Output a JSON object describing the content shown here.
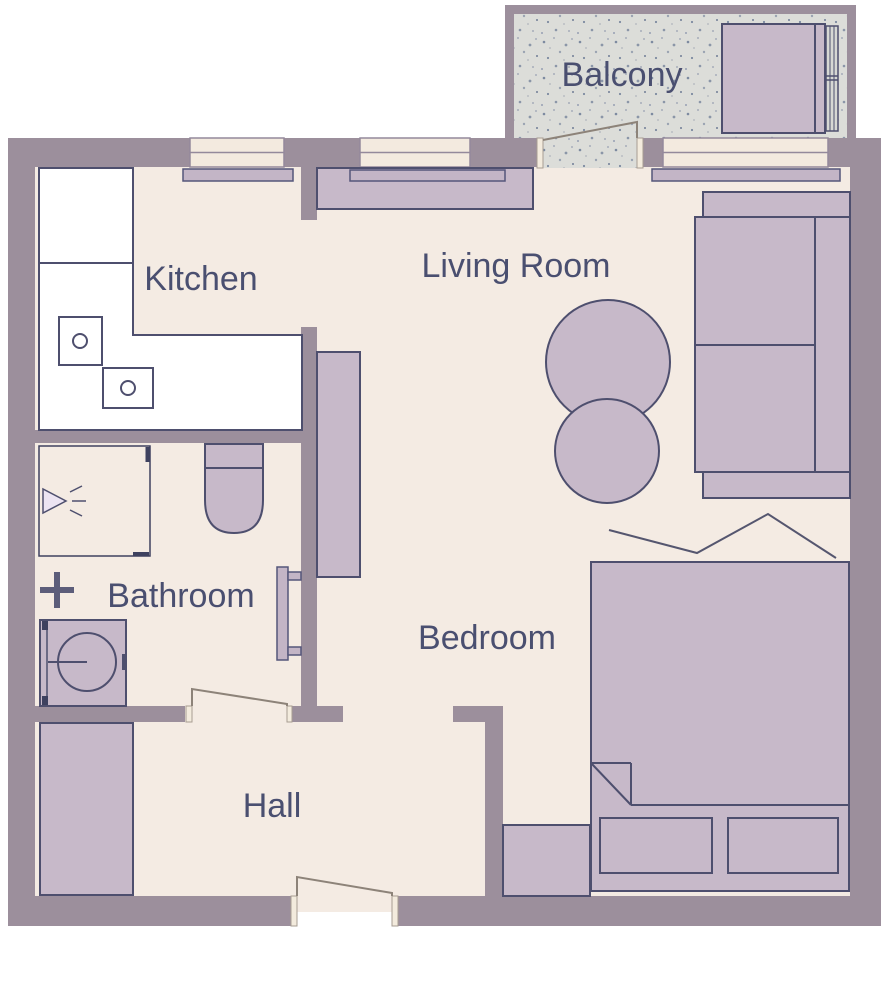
{
  "title": "Apartment Floor Plan",
  "rooms": {
    "balcony": {
      "label": "Balcony"
    },
    "kitchen": {
      "label": "Kitchen"
    },
    "living_room": {
      "label": "Living Room"
    },
    "bathroom": {
      "label": "Bathroom"
    },
    "bedroom": {
      "label": "Bedroom"
    },
    "hall": {
      "label": "Hall"
    }
  },
  "furniture": {
    "balcony": [
      "storage-box",
      "side-panel",
      "drying-rack"
    ],
    "kitchen": [
      "l-shaped-counter",
      "cooktop-burner-1",
      "cooktop-burner-2",
      "window",
      "windowsill"
    ],
    "living_room": [
      "tv-stand",
      "windowsill",
      "tall-wardrobe",
      "sofa",
      "round-table-large",
      "round-table-small",
      "window-left",
      "window-right",
      "balcony-door"
    ],
    "bathroom": [
      "shower-cabin",
      "shower-head",
      "wall-cross-fitting",
      "washing-machine",
      "toilet",
      "towel-radiator",
      "door"
    ],
    "bedroom": [
      "double-bed",
      "blanket-fold",
      "pillow-left",
      "pillow-right",
      "nightstand",
      "wall-zigzag-decor"
    ],
    "hall": [
      "wardrobe",
      "entrance-door",
      "bathroom-door"
    ]
  },
  "colors": {
    "wall": "#9c8f9c",
    "floor": "#f4ebe3",
    "furniture": "#c7b9c9",
    "outline": "#4e4f6e",
    "balcony_floor": "#dcddd9",
    "window": "#f3eadf",
    "door_jamb": "#f3ebdd",
    "label_text": "#4a4f70",
    "counter": "#ffffff"
  }
}
